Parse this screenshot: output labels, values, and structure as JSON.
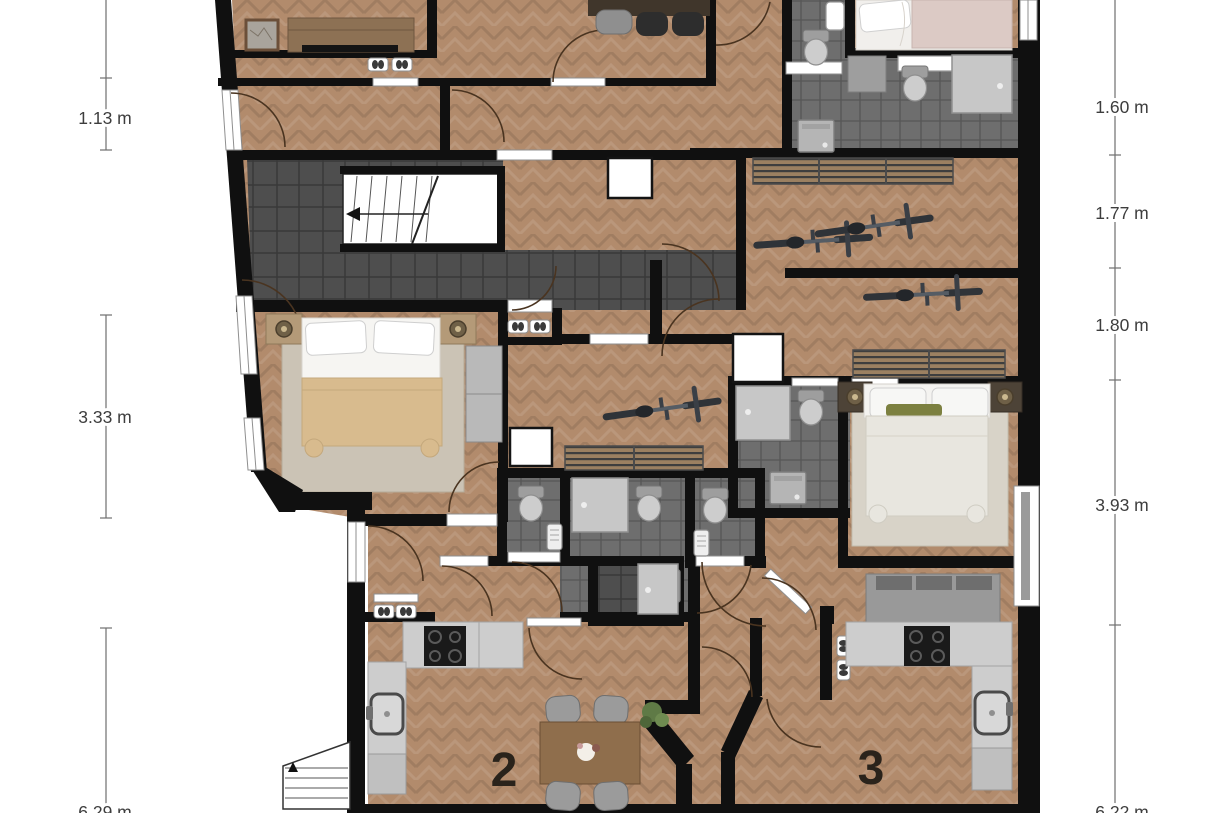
{
  "plan": {
    "type": "apartment-floor-plan",
    "left_dimensions": [
      "1.13 m",
      "3.33 m",
      "6.29 m"
    ],
    "right_dimensions": [
      "1.60 m",
      "1.77 m",
      "1.80 m",
      "3.93 m",
      "6.22 m"
    ],
    "apartment_labels": [
      "2",
      "3"
    ],
    "colors": {
      "wall": "#101010",
      "wood_floor": "#b28b6c",
      "corridor_tile": "#4e4e4e",
      "bathroom_tile": "#6e6e6e",
      "rug_left_bedroom": "#cbc3b5",
      "rug_right_bedroom": "#d8d3c8",
      "duvet_tan": "#d8bb8e",
      "blanket_pink": "#dccac5",
      "kitchen_counter": "#cdcdcd",
      "cooktop": "#1a1a1a",
      "sofa": "#999999",
      "dimension_text": "#3d3d3d"
    },
    "furniture_icons": [
      "double-bed-icon x3",
      "dining-table-icon x2",
      "chair-icon x7",
      "sofa-icon",
      "bicycle-icon x3",
      "toilet-icon x6",
      "shower-icon x4",
      "washing-machine-icon x3",
      "kitchen-sink-icon x2",
      "cooktop-icon x2",
      "radiator-icon x3",
      "wardrobe-icon",
      "nightstand-icon x4",
      "lamp-icon x4",
      "staircase-icon",
      "exterior-stairs-icon",
      "shoe-rack-icon x4",
      "plant-icon x2",
      "picture-icon",
      "sideboard-icon",
      "tv-icon",
      "shaft-icon x3",
      "window-icon x6",
      "door-arc-icon x18"
    ]
  }
}
